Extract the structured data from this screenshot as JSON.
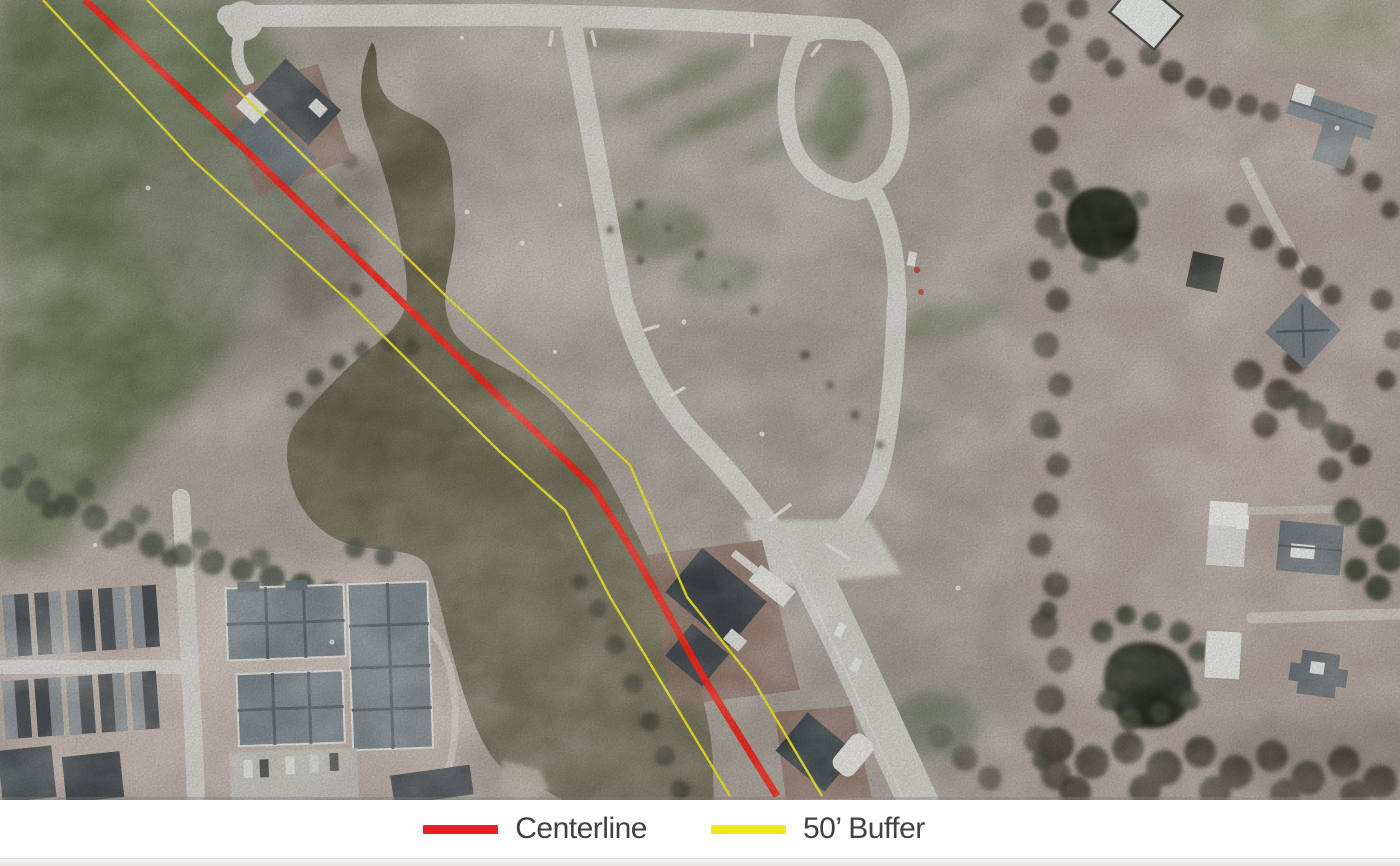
{
  "figure": {
    "kind": "aerial-map-exhibit",
    "description": "Aerial photograph of a partially built residential subdivision with a creek/pond, road network, townhouse complex and rural lots, overlaid with a pipeline centerline and 50-foot buffer lines"
  },
  "legend": {
    "items": [
      {
        "id": "centerline",
        "label": "Centerline",
        "color": "#e32027"
      },
      {
        "id": "buffer-50ft",
        "label": "50’ Buffer",
        "color": "#f0e822"
      }
    ]
  },
  "map": {
    "overlay": {
      "centerline_color": "#f1261a",
      "centerline_points": "85,0 253,157 400,300 500,398 560,455 593,487 638,560 705,680 777,796",
      "buffer_color": "#f0e81f",
      "buffer_left_points": "43,0 193,160 347,300 500,452 565,510 610,597 660,680 730,796",
      "buffer_right_points": "147,0 300,152 450,300 560,400 630,465 687,597 753,680 822,796"
    },
    "base_colors": {
      "ground": "#a8a197",
      "grass": "#727d5f",
      "water": "#6a6750",
      "road": "#d6d4cd",
      "trees": "#4c5342",
      "roof_dark": "#3f464a",
      "roof_gray": "#7e8a8e",
      "brick_pad": "#8d7164"
    },
    "features": [
      "creek-and-pond",
      "subdivision-roads",
      "cul-de-sac",
      "loop-road",
      "houses-under-construction",
      "townhouse-complex",
      "apartment-buildings",
      "rural-houses",
      "farm-ponds",
      "wooded-bands"
    ]
  }
}
